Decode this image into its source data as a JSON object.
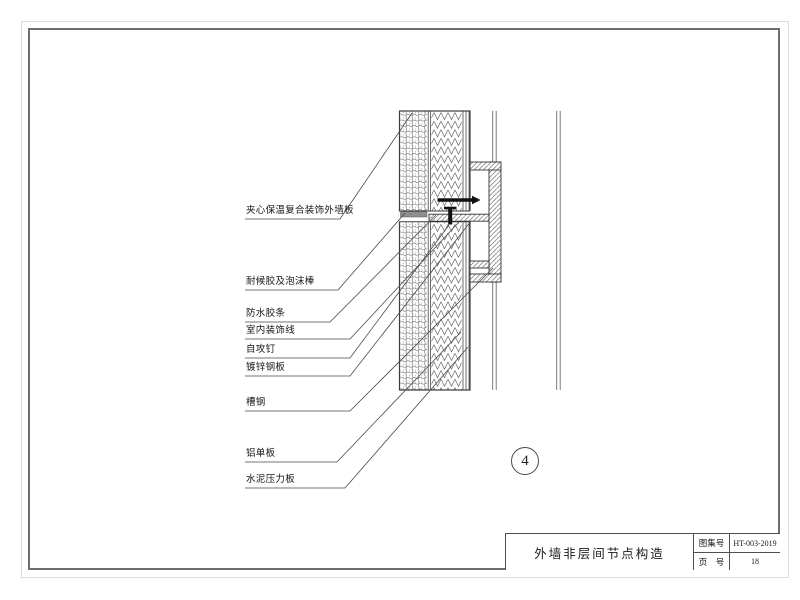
{
  "sheet": {
    "detail_number": "4",
    "border_color": "#6e6e6e",
    "background": "#ffffff"
  },
  "title_block": {
    "title": "外墙非层间节点构造",
    "fields": [
      {
        "label": "图集号",
        "value": "HT-003-2019"
      },
      {
        "label": "页　号",
        "value": "18"
      }
    ]
  },
  "callouts": [
    {
      "text": "夹心保温复合装饰外墙板"
    },
    {
      "text": "耐候胶及泡沫棒"
    },
    {
      "text": "防水胶条"
    },
    {
      "text": "室内装饰线"
    },
    {
      "text": "自攻钉"
    },
    {
      "text": "镀锌钢板"
    },
    {
      "text": "槽钢"
    },
    {
      "text": "铝单板"
    },
    {
      "text": "水泥压力板"
    }
  ]
}
